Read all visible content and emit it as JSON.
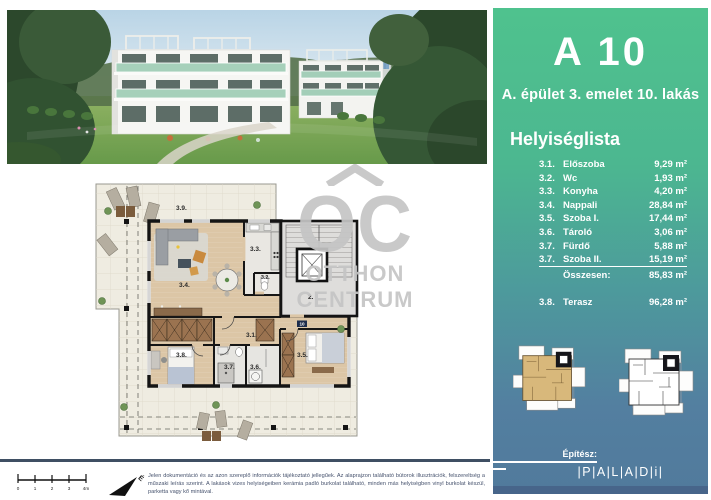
{
  "unit": {
    "title": "A 10",
    "subtitle": "A. épület 3. emelet 10. lakás"
  },
  "room_list": {
    "heading": "Helyiséglista",
    "rows": [
      {
        "num": "3.1.",
        "name": "Előszoba",
        "area": "9,29 m²"
      },
      {
        "num": "3.2.",
        "name": "Wc",
        "area": "1,93 m²"
      },
      {
        "num": "3.3.",
        "name": "Konyha",
        "area": "4,20 m²"
      },
      {
        "num": "3.4.",
        "name": "Nappali",
        "area": "28,84 m²"
      },
      {
        "num": "3.5.",
        "name": "Szoba I.",
        "area": "17,44 m²"
      },
      {
        "num": "3.6.",
        "name": "Tároló",
        "area": "3,06 m²"
      },
      {
        "num": "3.7.",
        "name": "Fürdő",
        "area": "5,88 m²"
      },
      {
        "num": "3.7.",
        "name": "Szoba II.",
        "area": "15,19 m²"
      }
    ],
    "total_label": "Összesen:",
    "total_area": "85,83 m²",
    "terrace": {
      "num": "3.8.",
      "name": "Terasz",
      "area": "96,28 m²"
    }
  },
  "floor_plan": {
    "labels": {
      "terrace": "3.9.",
      "living": "3.4.",
      "kitchen": "3.3.",
      "wc": "3.2.",
      "hall": "3.1.",
      "bedroom_left": "3.8.",
      "bath": "3.7.",
      "storage": "3.6.",
      "bedroom_right": "3.5.",
      "stair_core": "2."
    },
    "entry_badge": "10"
  },
  "watermark": {
    "mark": "OC",
    "line1": "OTTHON",
    "line2": "CENTRUM"
  },
  "footer": {
    "architect_label": "Építész:",
    "architect_logo": "|P|A|L|A|D|i|",
    "disclaimer": "Jelen dokumentáció és az azon szereplő információk tájékoztató jellegűek.  Az alaprajzon található bútorok illusztrációk, felszereltség a műszaki leírás szerint. A lakások vizes helyiségeiben kerámia padló burkolat található, minden más helyiségben vinyl burkolat készül, parketta vagy kő mintával.",
    "scale_ticks": [
      "0",
      "1",
      "2",
      "3",
      "4m"
    ],
    "north_symbol": "É"
  },
  "colors": {
    "panel_green": "#4fc28e",
    "panel_blue": "#517a9c",
    "divider_navy": "#3f4f63",
    "terrace_beige": "#efece1",
    "wood_floor": "#dcc6a6",
    "highlight_tan": "#d8b87b",
    "watermark_gray": "#c5c5c5"
  }
}
